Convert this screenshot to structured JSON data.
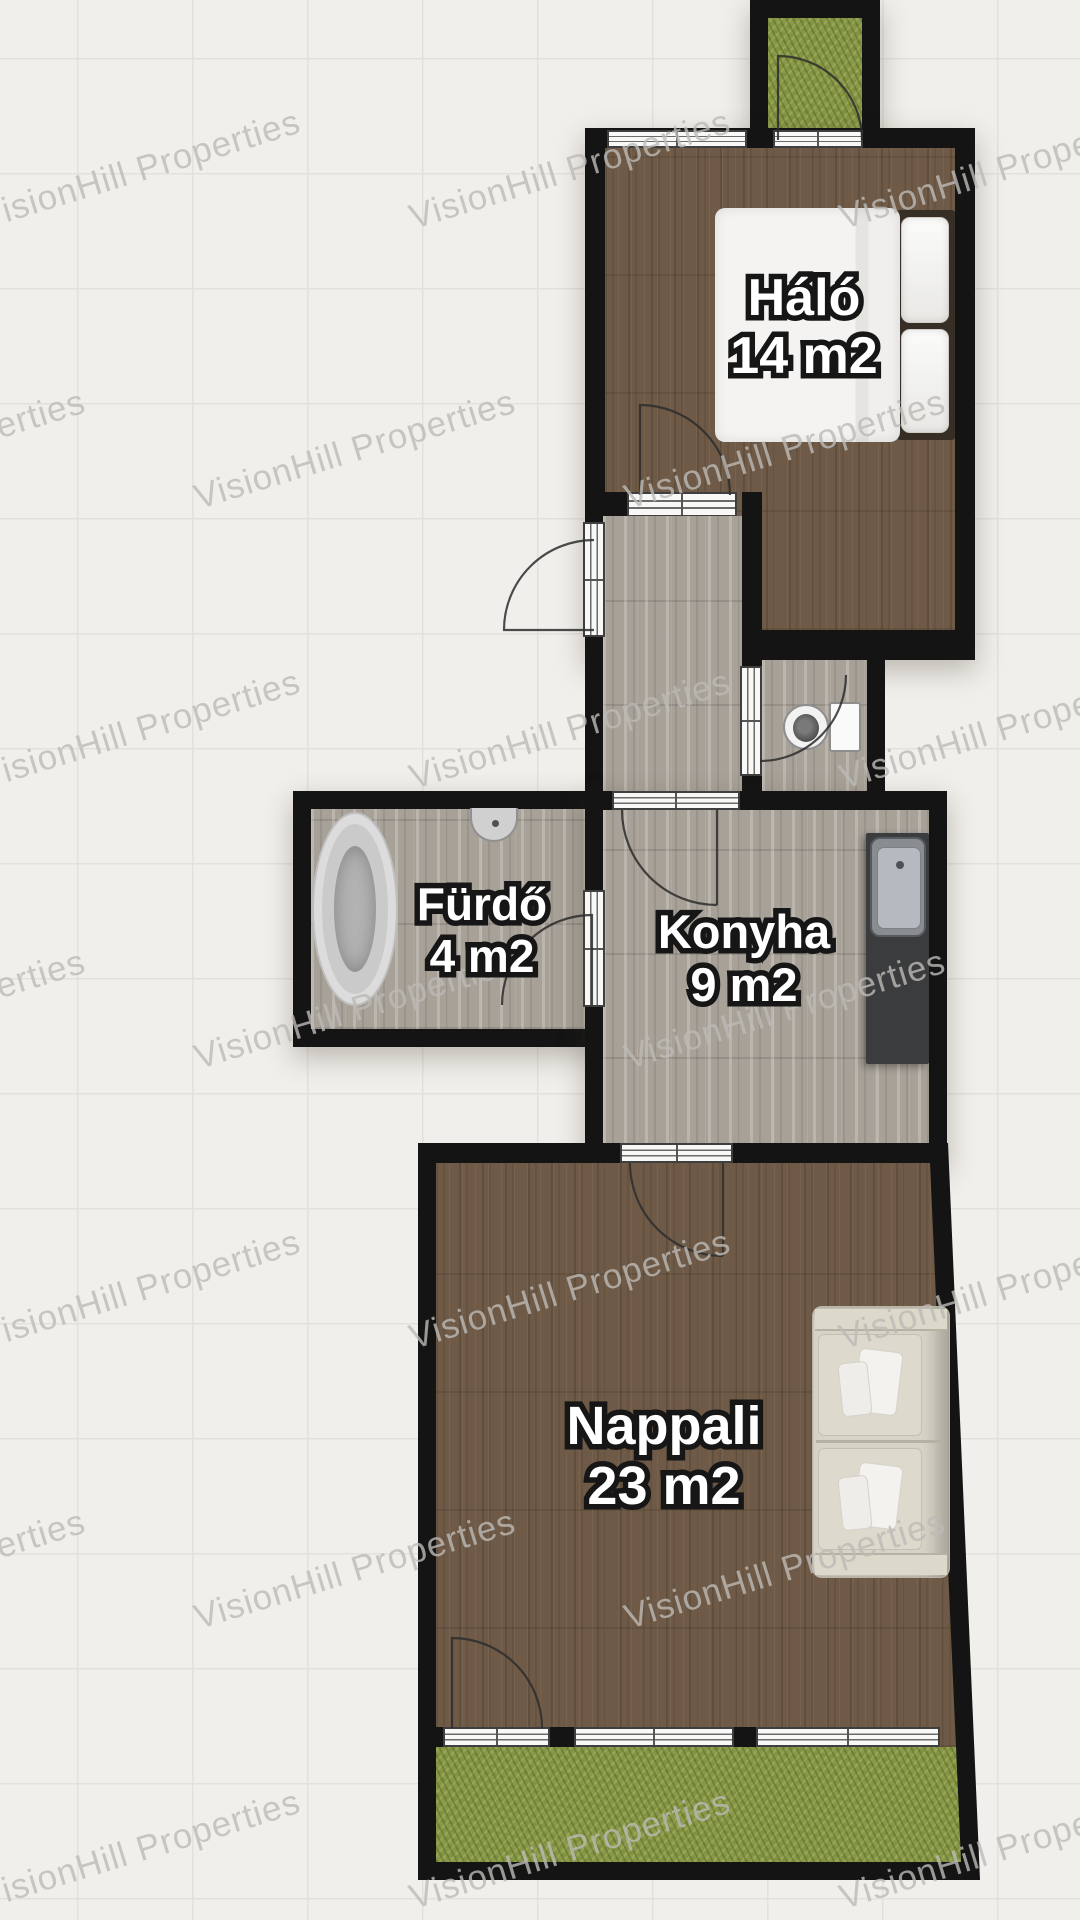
{
  "watermark": {
    "text": "VisionHill Properties"
  },
  "plan": {
    "rooms": [
      {
        "id": "halo",
        "name": "Háló",
        "area": "14 m2"
      },
      {
        "id": "furdo",
        "name": "Fürdő",
        "area": "4 m2"
      },
      {
        "id": "konyha",
        "name": "Konyha",
        "area": "9 m2"
      },
      {
        "id": "nappali",
        "name": "Nappali",
        "area": "23 m2"
      }
    ],
    "colors": {
      "wall": "#141414",
      "dark_wood_floor": "#6e5a46",
      "gray_wood_floor": "#a7a198",
      "grass": "#89994b",
      "background": "#f1efeb",
      "grid_line": "#e3e1dc",
      "label_fill": "#ffffff",
      "label_outline": "#161616",
      "kitchen_counter": "#3b3c3e",
      "watermark_text": "#bdbbb7"
    }
  }
}
